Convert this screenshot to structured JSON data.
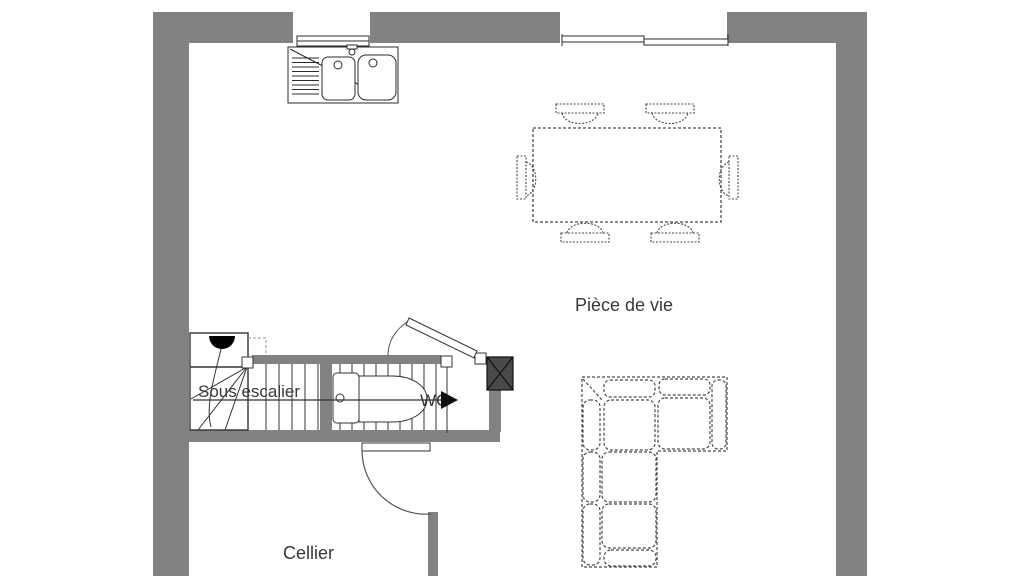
{
  "plan": {
    "type": "floor-plan",
    "rooms": {
      "living": {
        "label": "Pièce de vie"
      },
      "under_stairs": {
        "label": "Sous escalier"
      },
      "wc": {
        "label": "WC"
      },
      "cellar": {
        "label": "Cellier"
      }
    },
    "furniture": [
      "kitchen-double-sink-with-drainboard",
      "kitchen-window",
      "living-sliding-window",
      "dining-table-six-chairs",
      "corner-sofa",
      "staircase-with-winder-steps",
      "stair-direction-arrow",
      "toilet",
      "duct-shaft",
      "wc-door",
      "cellar-door"
    ],
    "colors": {
      "wall": "#828282",
      "duct": "#4a4a4a",
      "outline": "#2b2b2b",
      "furniture_line": "#4a4a4a",
      "text": "#383838",
      "background": "#ffffff"
    }
  }
}
